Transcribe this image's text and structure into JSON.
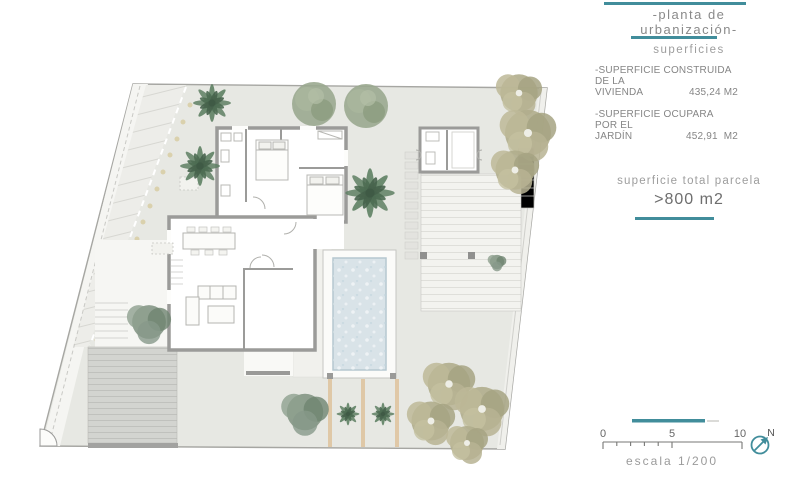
{
  "colors": {
    "accent_teal": "#418d9b",
    "text_gray": "#8a8a8a",
    "ground_gray": "#e7e8e3",
    "wall_gray": "#9b9b99",
    "pool_water": "#d9e3e8",
    "palm_green": "#5e7f63",
    "olive_green": "#b0ad8c"
  },
  "legend": {
    "title_line1": "-planta de",
    "title_line2": "urbanización-",
    "subtitle": "superficies",
    "surfaces": [
      {
        "line1": "-SUPERFICIE CONSTRUIDA DE LA",
        "line2": "VIVIENDA",
        "value": "435,24 M2"
      },
      {
        "line1": "-SUPERFICIE OCUPARA POR EL",
        "line2": "JARDÍN",
        "value": "452,91  M2"
      }
    ],
    "total_label": "superficie total parcela",
    "total_value": ">800 m2"
  },
  "scale": {
    "t0": "0",
    "t5": "5",
    "t10": "10",
    "caption": "escala 1/200",
    "north": "N"
  }
}
